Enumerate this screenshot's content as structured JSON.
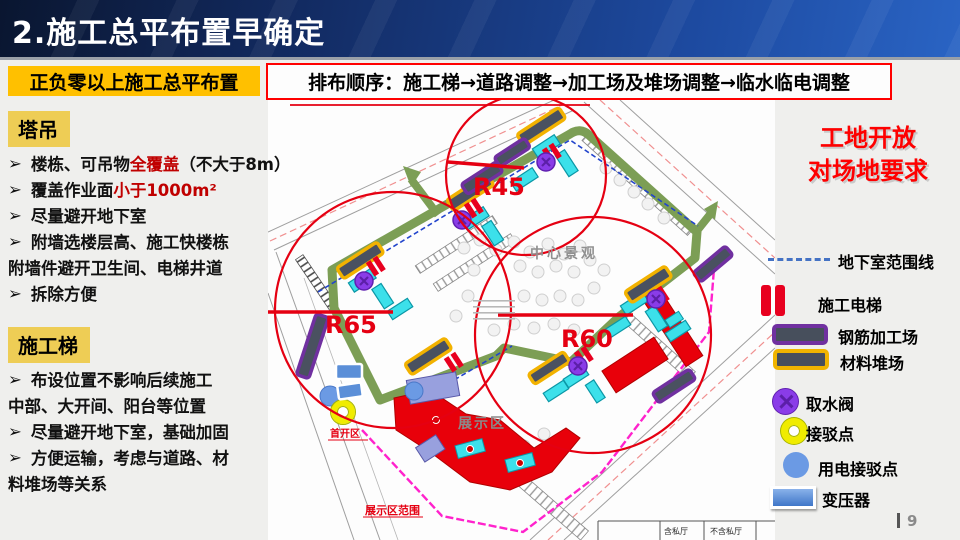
{
  "header": {
    "title": "2.施工总平布置早确定"
  },
  "subheader": {
    "left_label": "正负零以上施工总平布置",
    "order_text": "排布顺序：施工梯→道路调整→加工场及堆场调整→临水临电调整"
  },
  "left_panel": {
    "bullet_char": "➢",
    "section1": {
      "title": "塔吊",
      "lines": [
        {
          "bullet": true,
          "segments": [
            {
              "text": "楼栋、可吊物"
            },
            {
              "text": "全覆盖",
              "red": true
            },
            {
              "text": "（不大于8m）"
            }
          ]
        },
        {
          "bullet": true,
          "segments": [
            {
              "text": "覆盖作业面"
            },
            {
              "text": "小于1000m²",
              "red": true
            }
          ]
        },
        {
          "bullet": true,
          "segments": [
            {
              "text": "尽量避开地下室"
            }
          ]
        },
        {
          "bullet": true,
          "segments": [
            {
              "text": "附墙选楼层高、施工快楼栋"
            }
          ]
        },
        {
          "bullet": false,
          "segments": [
            {
              "text": "附墙件避开卫生间、电梯井道"
            }
          ]
        },
        {
          "bullet": true,
          "segments": [
            {
              "text": "拆除方便"
            }
          ]
        }
      ]
    },
    "section2": {
      "title": "施工梯",
      "lines": [
        {
          "bullet": true,
          "segments": [
            {
              "text": "布设位置不影响后续施工"
            }
          ]
        },
        {
          "bullet": false,
          "segments": [
            {
              "text": "中部、大开间、阳台等位置"
            }
          ]
        },
        {
          "bullet": true,
          "segments": [
            {
              "text": "尽量避开地下室，基础加固"
            }
          ]
        },
        {
          "bullet": true,
          "segments": [
            {
              "text": "方便运输，考虑与道路、材"
            }
          ]
        },
        {
          "bullet": false,
          "segments": [
            {
              "text": "料堆场等关系"
            }
          ]
        }
      ]
    }
  },
  "map": {
    "labels": {
      "r45": "R45",
      "r65": "R65",
      "r60": "R60",
      "center_landscape": "中心景观",
      "exhibit_area": "展示区",
      "first_open_area": "首开区",
      "exhibit_range": "展示区范围",
      "table_col1": "含私厅",
      "table_col2": "不含私厅"
    }
  },
  "right_panel": {
    "headline_line1": "工地开放",
    "headline_line2": "对场地要求",
    "legend": [
      {
        "key": "basement-range-line",
        "label": "地下室范围线"
      },
      {
        "key": "construction-elevator",
        "label": "施工电梯"
      },
      {
        "key": "rebar-workshop",
        "label": "钢筋加工场"
      },
      {
        "key": "material-yard",
        "label": "材料堆场"
      },
      {
        "key": "water-valve",
        "label": "取水阀"
      },
      {
        "key": "tap-point",
        "label": "接驳点"
      },
      {
        "key": "power-tap-point",
        "label": "用电接驳点"
      },
      {
        "key": "transformer",
        "label": "变压器"
      }
    ]
  },
  "footer": {
    "page_number": "9"
  },
  "colors": {
    "header_blue_dark": "#0a1630",
    "header_blue_light": "#2a64c4",
    "highlight_yellow": "#ffc000",
    "tag_yellow": "#eecd55",
    "accent_red": "#ff0000",
    "text_red": "#c00000",
    "crane_circle_red": "#e50012",
    "ring_road_green": "#7c9e55",
    "basement_line_blue": "#4472c4",
    "rebar_purple": "#7030a0",
    "material_yellow": "#f0b400",
    "yard_fill": "#474f5c",
    "valve_violet": "#8a3ce8",
    "tap_yellow": "#f0ec00",
    "power_blue": "#6b9ae4",
    "building_cyan": "#3ce0ea",
    "exhibit_red": "#e8000a",
    "fence_magenta": "#ff22cc"
  }
}
